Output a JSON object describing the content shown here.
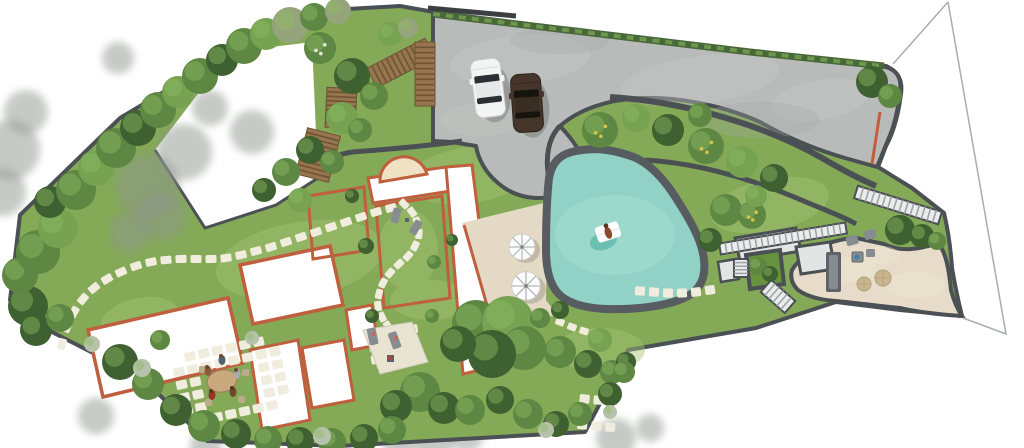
{
  "meta": {
    "title": "Residential landscape master plan – top-down rendering",
    "description": "Top-down architectural landscape plan of a villa garden with parking court, free-form swimming pool, sun patio, roof terraces, stepping-stone paths, garden stairs and perimeter planting."
  },
  "palette": {
    "bg": "#ffffff",
    "lawn": "#84a957",
    "lawn_hi": "#a4c573",
    "lawn_dark": "#69923f",
    "foliage": "#5d8742",
    "foliage_dark": "#3f6030",
    "foliage_light": "#76a251",
    "foliage_hi": "#8fba63",
    "olive": "#96a47c",
    "flower_shrub": "#b7c2ad",
    "flower_yellow": "#d9c34d",
    "flower_white": "#e4eadd",
    "hedge": "#49683a",
    "shadow_gray": "#8f968f",
    "path_dark": "#4b5054",
    "driveway": "#b8bbb9",
    "drive_hi": "#c6c9c7",
    "drive_lo": "#a6a9a7",
    "pool_water": "#92d1c6",
    "pool_water_hi": "#abdfd5",
    "pool_shadow": "#5fb8ab",
    "pool_coping": "#575c60",
    "patio": "#e4d9c5",
    "terrace_beige": "#e6dcc9",
    "beige_hi": "#efe7d6",
    "terracotta": "#bf5f3d",
    "terrace_white": "#ffffff",
    "stone": "#f1edde",
    "wood": "#97754f",
    "wood_dark": "#6e5335",
    "stair_tread": "#e9eceb",
    "stair_gap": "#9aa0a3",
    "landing": "#e2e5e4",
    "furn_gray": "#878c90",
    "furn_dark": "#5e6367",
    "pouf": "#c9b68e",
    "table_wood": "#c8a87c",
    "car_white": "#f3f4f4",
    "car_brown": "#46352a",
    "car_window": "#22262a",
    "boundary": "#a9adab",
    "arch_fill": "#efe2c4",
    "paver_patch": "#e9e4d2",
    "accent_blue": "#3f7fae",
    "accent_red": "#b5452f"
  },
  "features": {
    "driveway": {
      "label": "concrete parking court",
      "cars": [
        {
          "name": "white-car"
        },
        {
          "name": "brown-car"
        }
      ]
    },
    "pool": {
      "label": "free-form swimming pool",
      "float": "white pool float with bather"
    },
    "sun_patio": {
      "label": "travertine sun patio",
      "umbrellas": 2,
      "loungers": 2
    },
    "house": {
      "label": "villa roof terraces with terracotta edging",
      "entry_arch": "semicircular canopy"
    },
    "courtyards": {
      "label": "lawn courtyards with stepping-stone paths"
    },
    "dining_area": {
      "label": "outdoor dining on paver grid",
      "guests": 5
    },
    "lounge_terrace": {
      "label": "lower stone lounge terrace",
      "furniture": [
        "outdoor-sofa",
        "side-tables",
        "poufs",
        "chairs"
      ]
    },
    "stairs": {
      "stone_flights": 4,
      "timber_flights": 4
    },
    "planting": {
      "label": "perimeter trees, hedges, flowering shrubs"
    },
    "boundary": {
      "label": "surveyed property boundary lines"
    }
  },
  "plan": {
    "shadows_outer": [
      [
        10,
        150,
        30
      ],
      [
        2,
        192,
        24
      ],
      [
        26,
        112,
        22
      ],
      [
        80,
        250,
        20
      ],
      [
        118,
        58,
        16
      ],
      [
        96,
        416,
        18
      ],
      [
        206,
        446,
        16
      ],
      [
        432,
        440,
        22
      ],
      [
        466,
        434,
        18
      ],
      [
        398,
        446,
        15
      ],
      [
        616,
        438,
        20
      ],
      [
        650,
        428,
        14
      ]
    ],
    "shadows_inner": [
      [
        148,
        186,
        32
      ],
      [
        184,
        152,
        28
      ],
      [
        162,
        216,
        24
      ],
      [
        130,
        232,
        20
      ],
      [
        252,
        132,
        22
      ],
      [
        210,
        108,
        18
      ]
    ],
    "trees": [
      [
        28,
        306,
        20,
        "b"
      ],
      [
        20,
        275,
        18,
        "a"
      ],
      [
        38,
        252,
        22,
        "a"
      ],
      [
        58,
        228,
        20,
        "c"
      ],
      [
        50,
        202,
        16,
        "b"
      ],
      [
        76,
        190,
        20,
        "a"
      ],
      [
        96,
        168,
        18,
        "c"
      ],
      [
        116,
        148,
        20,
        "a"
      ],
      [
        138,
        128,
        18,
        "b"
      ],
      [
        158,
        110,
        18,
        "a"
      ],
      [
        178,
        92,
        16,
        "c"
      ],
      [
        200,
        76,
        18,
        "a"
      ],
      [
        222,
        60,
        16,
        "b"
      ],
      [
        244,
        46,
        18,
        "a"
      ],
      [
        266,
        34,
        16,
        "c"
      ],
      [
        290,
        25,
        18,
        "d"
      ],
      [
        314,
        17,
        14,
        "a"
      ],
      [
        338,
        11,
        13,
        "d"
      ],
      [
        36,
        330,
        16,
        "b"
      ],
      [
        60,
        318,
        14,
        "a"
      ],
      [
        320,
        48,
        16,
        "a",
        "w"
      ],
      [
        352,
        76,
        18,
        "b"
      ],
      [
        374,
        96,
        14,
        "a"
      ],
      [
        342,
        118,
        16,
        "c"
      ],
      [
        310,
        150,
        14,
        "b"
      ],
      [
        286,
        172,
        14,
        "a"
      ],
      [
        264,
        190,
        12,
        "b"
      ],
      [
        332,
        162,
        12,
        "a"
      ],
      [
        300,
        200,
        12,
        "c"
      ],
      [
        360,
        130,
        12,
        "a"
      ],
      [
        390,
        34,
        12,
        "c"
      ],
      [
        408,
        28,
        10,
        "d"
      ],
      [
        600,
        130,
        18,
        "a",
        "y"
      ],
      [
        636,
        118,
        14,
        "c"
      ],
      [
        668,
        130,
        16,
        "b"
      ],
      [
        706,
        146,
        18,
        "a",
        "y"
      ],
      [
        742,
        162,
        16,
        "c"
      ],
      [
        774,
        178,
        14,
        "b"
      ],
      [
        700,
        115,
        12,
        "a"
      ],
      [
        872,
        82,
        16,
        "b"
      ],
      [
        890,
        96,
        12,
        "a"
      ],
      [
        726,
        210,
        16,
        "a"
      ],
      [
        752,
        215,
        14,
        "a",
        "y"
      ],
      [
        710,
        240,
        12,
        "b"
      ],
      [
        756,
        196,
        11,
        "c"
      ],
      [
        900,
        230,
        15,
        "b"
      ],
      [
        922,
        236,
        12,
        "b"
      ],
      [
        937,
        241,
        9,
        "a"
      ],
      [
        758,
        266,
        9,
        "a"
      ],
      [
        770,
        274,
        8,
        "b"
      ],
      [
        560,
        352,
        16,
        "a"
      ],
      [
        588,
        364,
        14,
        "b"
      ],
      [
        612,
        372,
        12,
        "a"
      ],
      [
        600,
        340,
        12,
        "c"
      ],
      [
        626,
        362,
        10,
        "b"
      ],
      [
        476,
        324,
        24,
        "a"
      ],
      [
        508,
        322,
        26,
        "c"
      ],
      [
        524,
        348,
        22,
        "a"
      ],
      [
        492,
        354,
        24,
        "b"
      ],
      [
        458,
        344,
        18,
        "b"
      ],
      [
        420,
        392,
        20,
        "a"
      ],
      [
        396,
        406,
        16,
        "b"
      ],
      [
        444,
        408,
        16,
        "b"
      ],
      [
        470,
        410,
        15,
        "a"
      ],
      [
        120,
        362,
        18,
        "b"
      ],
      [
        148,
        384,
        16,
        "a"
      ],
      [
        176,
        410,
        16,
        "b"
      ],
      [
        204,
        426,
        16,
        "a"
      ],
      [
        236,
        434,
        15,
        "b"
      ],
      [
        268,
        440,
        14,
        "a"
      ],
      [
        300,
        441,
        14,
        "b"
      ],
      [
        332,
        442,
        14,
        "a"
      ],
      [
        364,
        438,
        14,
        "b"
      ],
      [
        392,
        430,
        14,
        "a"
      ],
      [
        500,
        400,
        14,
        "b"
      ],
      [
        528,
        414,
        15,
        "a"
      ],
      [
        556,
        424,
        13,
        "b"
      ],
      [
        580,
        414,
        12,
        "a"
      ],
      [
        610,
        394,
        12,
        "b"
      ],
      [
        624,
        372,
        11,
        "a"
      ],
      [
        142,
        368,
        9,
        "e"
      ],
      [
        322,
        436,
        9,
        "e"
      ],
      [
        546,
        430,
        8,
        "e"
      ],
      [
        610,
        412,
        7,
        "e"
      ],
      [
        252,
        338,
        7,
        "e"
      ],
      [
        92,
        344,
        8,
        "e"
      ],
      [
        366,
        246,
        8,
        "b"
      ],
      [
        434,
        262,
        7,
        "a"
      ],
      [
        372,
        316,
        7,
        "b"
      ],
      [
        432,
        316,
        7,
        "a"
      ],
      [
        540,
        318,
        10,
        "a"
      ],
      [
        160,
        340,
        10,
        "a"
      ],
      [
        452,
        240,
        6,
        "b"
      ],
      [
        352,
        196,
        7,
        "b"
      ],
      [
        560,
        310,
        9,
        "b"
      ]
    ],
    "stone_paths": [
      {
        "w": 11,
        "h": 8,
        "pts": [
          [
            62,
            344
          ],
          [
            67,
            327
          ],
          [
            74,
            312
          ],
          [
            83,
            299
          ],
          [
            94,
            288
          ],
          [
            107,
            279
          ],
          [
            121,
            272
          ],
          [
            136,
            266
          ],
          [
            151,
            262
          ],
          [
            166,
            260
          ],
          [
            181,
            259
          ],
          [
            196,
            259
          ],
          [
            211,
            259
          ],
          [
            226,
            258
          ],
          [
            241,
            255
          ],
          [
            256,
            251
          ],
          [
            271,
            247
          ],
          [
            286,
            242
          ],
          [
            301,
            237
          ],
          [
            316,
            232
          ],
          [
            331,
            227
          ],
          [
            346,
            222
          ],
          [
            361,
            217
          ],
          [
            376,
            212
          ],
          [
            391,
            208
          ]
        ]
      },
      {
        "w": 10,
        "h": 7,
        "pts": [
          [
            404,
            204
          ],
          [
            412,
            212
          ],
          [
            417,
            222
          ],
          [
            419,
            234
          ],
          [
            415,
            246
          ],
          [
            408,
            256
          ],
          [
            399,
            264
          ],
          [
            390,
            273
          ],
          [
            383,
            283
          ],
          [
            379,
            294
          ],
          [
            378,
            306
          ],
          [
            382,
            317
          ],
          [
            388,
            326
          ]
        ]
      },
      {
        "w": 10,
        "h": 9,
        "pts": [
          [
            640,
            291
          ],
          [
            654,
            292
          ],
          [
            668,
            293
          ],
          [
            682,
            293
          ],
          [
            696,
            292
          ],
          [
            710,
            290
          ]
        ]
      },
      {
        "w": 9,
        "h": 7,
        "pts": [
          [
            560,
            322
          ],
          [
            572,
            327
          ],
          [
            584,
            331
          ]
        ]
      }
    ],
    "stone_grids": [
      {
        "x": 170,
        "y": 356,
        "cols": 8,
        "rows": 6,
        "dx": 14,
        "dy": 13,
        "w": 11,
        "h": 9,
        "rot": -12,
        "skip": [
          0,
          7,
          18,
          19,
          20,
          21,
          26,
          27,
          28,
          29,
          34,
          35,
          36,
          37,
          40,
          47
        ]
      },
      {
        "x": 367,
        "y": 331,
        "cols": 4,
        "rows": 3,
        "dx": 13.5,
        "dy": 12.5,
        "w": 10,
        "h": 9,
        "rot": -8,
        "skip": [
          5
        ]
      },
      {
        "x": 580,
        "y": 394,
        "cols": 3,
        "rows": 3,
        "dx": 14,
        "dy": 13,
        "w": 10,
        "h": 9,
        "rot": 5,
        "skip": [
          4
        ]
      }
    ],
    "stairs": [
      [
        856,
        192,
        940,
        218,
        13,
        15,
        "stone"
      ],
      [
        720,
        249,
        846,
        228,
        11,
        21,
        "stone"
      ],
      [
        741,
        259,
        741,
        277,
        14,
        5,
        "stone"
      ],
      [
        766,
        286,
        790,
        307,
        16,
        6,
        "stone"
      ],
      [
        430,
        48,
        372,
        78,
        22,
        12,
        "wood"
      ],
      [
        342,
        88,
        340,
        128,
        30,
        9,
        "wood"
      ],
      [
        324,
        132,
        312,
        178,
        34,
        10,
        "wood"
      ],
      [
        425,
        42,
        425,
        106,
        20,
        12,
        "wood"
      ]
    ]
  }
}
